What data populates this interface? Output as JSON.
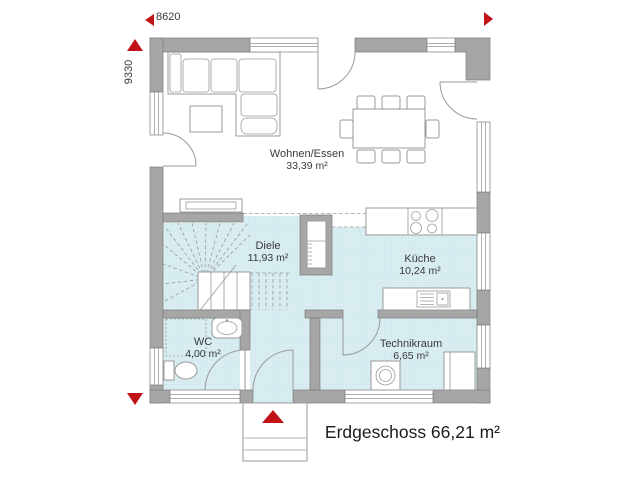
{
  "plan": {
    "dimensions": {
      "width_label": "8620",
      "height_label": "9330"
    },
    "rooms": [
      {
        "name": "Wohnen/Essen",
        "area": "33,39 m²"
      },
      {
        "name": "Diele",
        "area": "11,93 m²"
      },
      {
        "name": "Küche",
        "area": "10,24 m²"
      },
      {
        "name": "WC",
        "area": "4,00 m²"
      },
      {
        "name": "Technikraum",
        "area": "6,65 m²"
      }
    ],
    "footer": {
      "text": "Erdgeschoss 66,21 m²"
    },
    "colors": {
      "wall": "#a6a6a6",
      "wall_outline": "#7d7d7d",
      "floor_tile": "#daeef2",
      "tile_line": "#c6e3ea",
      "accent_red": "#c01318",
      "line": "#9a9a9a",
      "text": "#3a3a3a"
    }
  }
}
